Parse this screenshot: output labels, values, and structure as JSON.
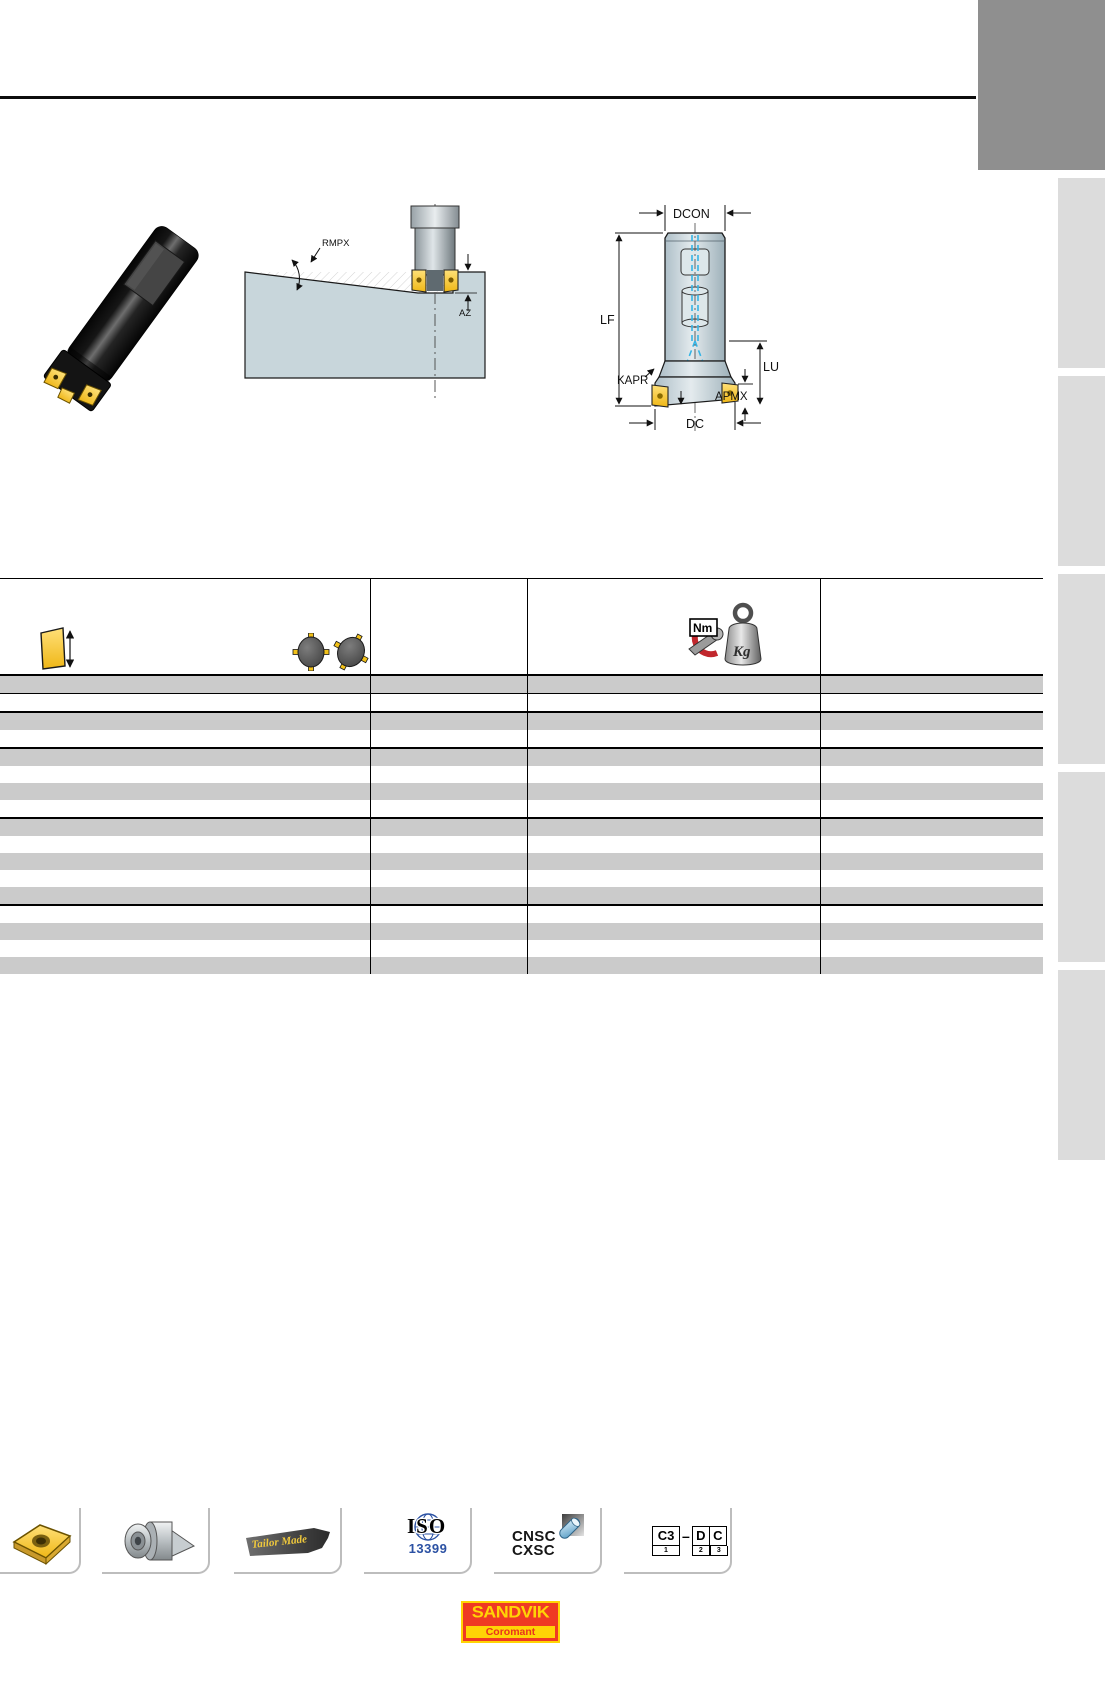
{
  "diagrams": {
    "ramping": {
      "labels": {
        "rmpx": "RMPX",
        "az": "AZ"
      },
      "description_icons": [
        "ramping-cutter-icon",
        "workpiece-icon"
      ]
    },
    "tool": {
      "labels": {
        "dcon": "DCON",
        "lf": "LF",
        "kapr": "KAPR",
        "apmx": "APMX",
        "lu": "LU",
        "dc": "DC"
      }
    }
  },
  "table": {
    "header_icons": [
      {
        "name": "insert-edge-length-icon"
      },
      {
        "name": "effective-teeth-icon"
      },
      {
        "name": "torque-icon",
        "label": "Nm"
      },
      {
        "name": "weight-icon",
        "label": "Kg"
      }
    ],
    "columns": 4,
    "rows": [
      {
        "shade": "gray",
        "sep": "thin"
      },
      {
        "shade": "white",
        "sep": "thick"
      },
      {
        "shade": "gray",
        "sep": "none"
      },
      {
        "shade": "white",
        "sep": "thick"
      },
      {
        "shade": "gray",
        "sep": "none"
      },
      {
        "shade": "white",
        "sep": "none"
      },
      {
        "shade": "gray",
        "sep": "none"
      },
      {
        "shade": "white",
        "sep": "thick"
      },
      {
        "shade": "gray",
        "sep": "none"
      },
      {
        "shade": "white",
        "sep": "none"
      },
      {
        "shade": "gray",
        "sep": "none"
      },
      {
        "shade": "white",
        "sep": "none"
      },
      {
        "shade": "gray",
        "sep": "thick"
      },
      {
        "shade": "white",
        "sep": "none"
      },
      {
        "shade": "gray",
        "sep": "none"
      },
      {
        "shade": "white",
        "sep": "none"
      },
      {
        "shade": "gray",
        "sep": "none"
      }
    ]
  },
  "footer": {
    "tailor_made": "Tailor Made",
    "iso": {
      "line1": "ISO",
      "line2": "13399"
    },
    "coupling": {
      "line1": "CNSC",
      "line2": "CXSC"
    },
    "code": {
      "c3": "C3",
      "sub1": "1",
      "dash": "–",
      "d": "D",
      "c": "C",
      "sub2": "2",
      "sub3": "3"
    }
  },
  "logo": {
    "brand": "SANDVIK",
    "sub": "Coromant"
  },
  "colors": {
    "insert_yellow": "#f2c118",
    "diagram_fill": "#c8d6db",
    "coolant_blue": "#35b4e5",
    "table_row_gray": "#cbcbcb",
    "sidebar_dark": "#8f8f8f",
    "sidebar_light": "#dcdcdc",
    "sandvik_red": "#ef3a23",
    "sandvik_yellow": "#ffd405",
    "iso_blue": "#2b51a3"
  }
}
